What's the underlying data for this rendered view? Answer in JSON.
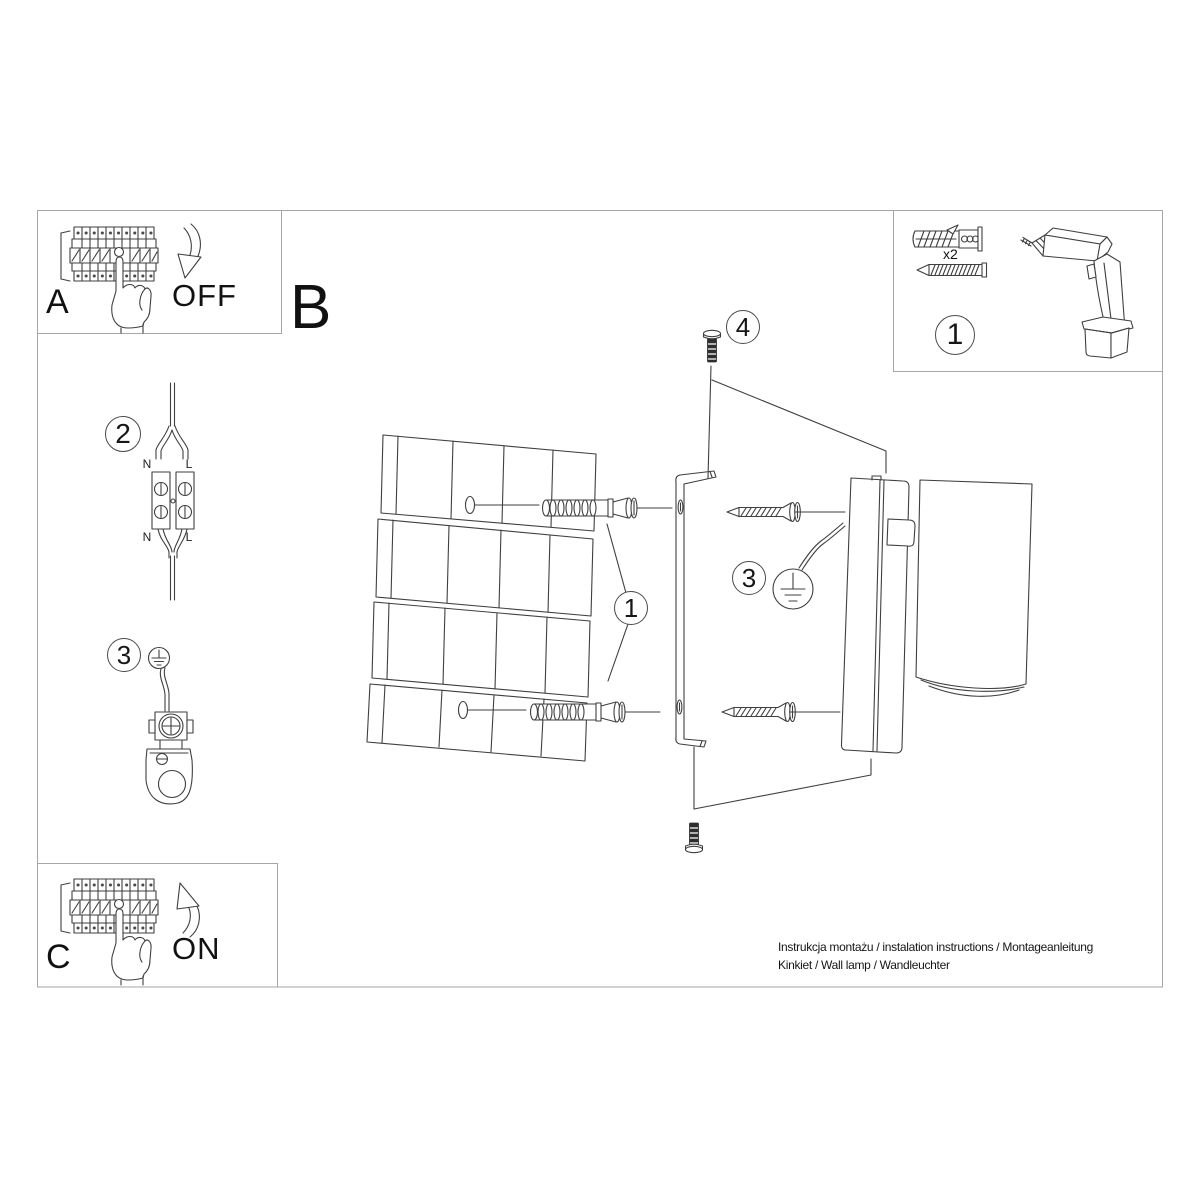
{
  "sheet": {
    "footer": {
      "line1": "Instrukcja montażu / instalation instructions / Montageanleitung",
      "line2": "Kinkiet / Wall lamp / Wandleuchter"
    }
  },
  "panel_a": {
    "label": "A",
    "action": "OFF"
  },
  "panel_b": {
    "label": "B"
  },
  "panel_c": {
    "label": "C",
    "action": "ON"
  },
  "tools_box": {
    "step_number": "1",
    "quantity_label": "x2"
  },
  "steps": {
    "main_anchor": "1",
    "wiring": "2",
    "ground_side": "3",
    "ground_main": "3",
    "top_screw": "4"
  },
  "wiring_labels": {
    "n_top": "N",
    "l_top": "L",
    "n_bottom": "N",
    "l_bottom": "L"
  },
  "colors": {
    "line": "#3f3f3f",
    "panel_border": "#a6a6a6",
    "text": "#111111"
  },
  "icons": {
    "breaker": "circuit-breaker-icon",
    "hand": "pointing-hand-icon",
    "arrow_off": "curved-arrow-down-icon",
    "arrow_on": "curved-arrow-up-icon",
    "wall_plug": "wall-plug-icon",
    "screw": "screw-icon",
    "drill": "drill-icon",
    "cable": "cable-split-icon",
    "terminal": "terminal-block-icon",
    "ground": "earth-ground-icon",
    "wall": "tile-wall-icon",
    "bracket": "mounting-bracket-icon",
    "lamp": "wall-lamp-body-icon"
  }
}
